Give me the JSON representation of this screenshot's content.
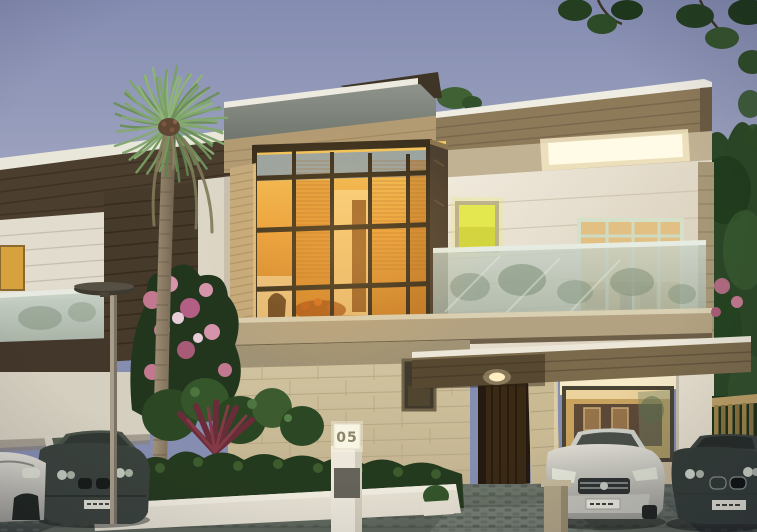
{
  "scene": {
    "type": "architectural-rendering",
    "description": "Modern two-storey villa at dusk with glowing double-height glass facade, palm tree, hedges and parked luxury cars on a cobbled driveway",
    "house_number": "05"
  },
  "palette": {
    "sky_top": "#858db1",
    "sky_bottom": "#bcb4bd",
    "glass_glow": "#eda23c",
    "warm_light": "#f7ecca",
    "wall_cream": "#e9e4d6",
    "wood_dark": "#4a3c2c",
    "wood_tan": "#b29a72",
    "stone": "#cdbf9e",
    "foliage_dark": "#2e4a27",
    "foliage_light": "#7fa76c",
    "flower_pink": "#c2788f",
    "yellow_window": "#e8ea58",
    "glass_rail": "#b7c3b9",
    "driveway": "#555e56",
    "car_silver": "#c9c9c1",
    "car_dark": "#343c36"
  }
}
